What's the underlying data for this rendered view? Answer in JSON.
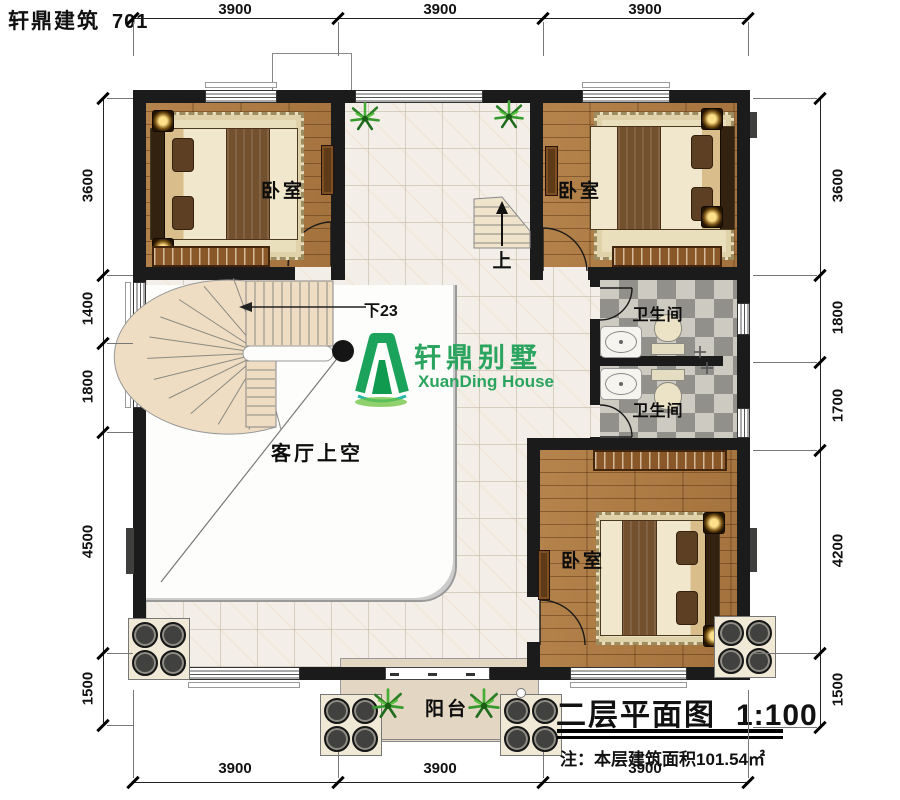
{
  "header": {
    "brand": "轩鼎建筑",
    "code": "701"
  },
  "dimensions": {
    "top": [
      "3900",
      "3900",
      "3900"
    ],
    "bottom": [
      "3900",
      "3900",
      "3900"
    ],
    "left": [
      "3600",
      "1400",
      "1800",
      "4500",
      "1500"
    ],
    "right": [
      "3600",
      "1800",
      "1700",
      "4200",
      "1500"
    ]
  },
  "rooms": {
    "bedroom_top_left": "卧室",
    "bedroom_top_right": "卧室",
    "bedroom_bottom_right": "卧室",
    "bathroom_upper": "卫生间",
    "bathroom_lower": "卫生间",
    "living_void": "客厅上空",
    "balcony": "阳台"
  },
  "stairs": {
    "up": "上",
    "down": "下23"
  },
  "logo": {
    "cn": "轩鼎别墅",
    "en": "XuanDing House",
    "color": "#2aa45e"
  },
  "title_block": {
    "title": "二层平面图",
    "scale": "1:100",
    "note": "注：本层建筑面积101.54㎡"
  },
  "colors": {
    "wall": "#1b1b1b",
    "wood_floor": "#b0804a",
    "tile_floor": "#f3efe8",
    "checker_dark": "#92908a",
    "checker_light": "#cdcac1",
    "balcony_floor": "#e3d6c2",
    "logo_green": "#2aa45e"
  }
}
